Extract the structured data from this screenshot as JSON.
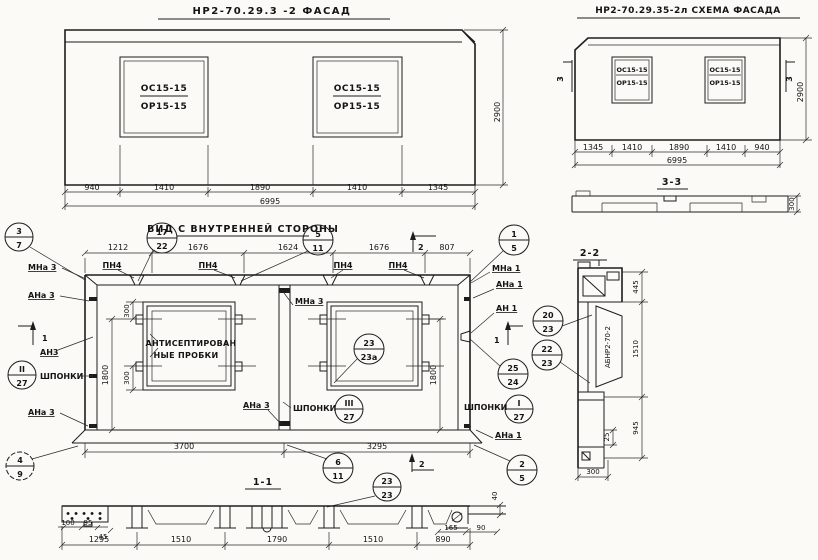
{
  "drawing": {
    "facade": {
      "title": "НР2-70.29.3 -2  ФАСАД",
      "window": {
        "top": "ОС15-15",
        "bottom": "ОР15-15"
      },
      "dims": [
        "940",
        "1410",
        "1890",
        "1410",
        "1345"
      ],
      "total": "6995",
      "height": "2900"
    },
    "scheme": {
      "title": "НР2-70.29.35-2л  СХЕМА ФАСАДА",
      "window": {
        "top": "ОС15-15",
        "bottom": "ОР15-15"
      },
      "dims": [
        "1345",
        "1410",
        "1890",
        "1410",
        "940"
      ],
      "total": "6995",
      "height": "2900",
      "mark": "3"
    },
    "section33": {
      "title": "3-3",
      "thickness": "300"
    },
    "inner": {
      "title": "ВИД С ВНУТРЕННЕЙ СТОРОНЫ",
      "top_dims": [
        "1212",
        "1676",
        "1624",
        "1676",
        "807"
      ],
      "pn": "ПН4",
      "plug_note1": "АНТИСЕПТИРОВАН",
      "plug_note2": "НЫЕ ПРОБКИ",
      "shponki": "ШПОНКИ",
      "labels": {
        "mna3": "МНа 3",
        "ana3": "АНа 3",
        "an3": "АН3",
        "mna1": "МНа 1",
        "ana1": "АНа 1",
        "an1": "АН 1"
      },
      "marks": {
        "s1": "1",
        "s2": "2"
      },
      "dims": {
        "d300": "300",
        "d1800": "1800",
        "left": "3700",
        "right": "3295"
      },
      "callouts": {
        "c37": {
          "t": "3",
          "b": "7"
        },
        "c1722": {
          "t": "17",
          "b": "22"
        },
        "c511": {
          "t": "5",
          "b": "11"
        },
        "c15": {
          "t": "1",
          "b": "5"
        },
        "c227": {
          "t": "II",
          "b": "27"
        },
        "c327": {
          "t": "III",
          "b": "27"
        },
        "c127": {
          "t": "I",
          "b": "27"
        },
        "c2323a": {
          "t": "23",
          "b": "23а"
        },
        "c2524": {
          "t": "25",
          "b": "24"
        },
        "c49": {
          "t": "4",
          "b": "9"
        },
        "c611": {
          "t": "6",
          "b": "11"
        },
        "c25": {
          "t": "2",
          "b": "5"
        },
        "c2323": {
          "t": "23",
          "b": "23"
        }
      }
    },
    "section22": {
      "title": "2-2",
      "stamp": "АБНР2-70-2",
      "dims": [
        "445",
        "1510",
        "945"
      ],
      "step": "25",
      "width": "300",
      "callouts": {
        "c2023": {
          "t": "20",
          "b": "23"
        },
        "c2223": {
          "t": "22",
          "b": "23"
        }
      }
    },
    "section11": {
      "title": "1-1",
      "dims": [
        "1295",
        "1510",
        "1790",
        "1510",
        "890"
      ],
      "small": {
        "d100": "100",
        "d95": "95",
        "d45": "45",
        "d165": "165",
        "d90": "90",
        "d40": "40"
      }
    }
  }
}
